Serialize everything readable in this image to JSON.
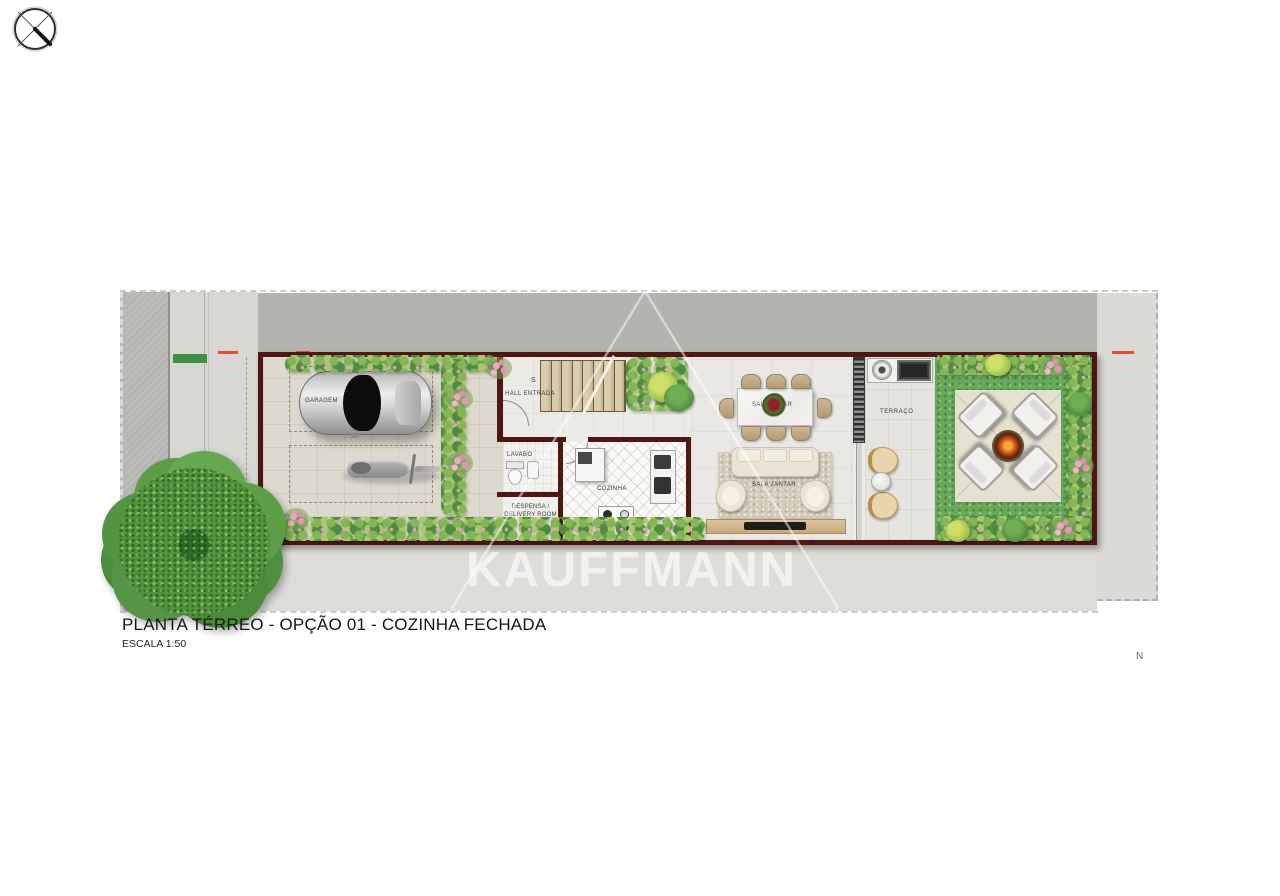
{
  "title": {
    "main": "PLANTA TÉRREO - OPÇÃO 01 - COZINHA FECHADA",
    "scale": "ESCALA 1:50"
  },
  "watermark": {
    "text": "KAUFFMANN"
  },
  "compass": {
    "north": "N"
  },
  "rooms": {
    "garage": "GARAGEM",
    "hall": "HALL ENTRADA",
    "stairs": "S",
    "lavabo": "LAVABO",
    "pantry_line1": "DESPENSA /",
    "pantry_line2": "DELIVERY ROOM",
    "kitchen": "COZINHA",
    "sala_estar": "SALA ESTAR",
    "sala_jantar": "SALA JANTAR",
    "terrace": "TERRAÇO"
  },
  "colors": {
    "wall": "#4e1712",
    "lawn": "#68a95e",
    "neighbor_gray": "#b4b3b0",
    "paving": "#ded9ce",
    "accent_dash": "#e4502e"
  }
}
